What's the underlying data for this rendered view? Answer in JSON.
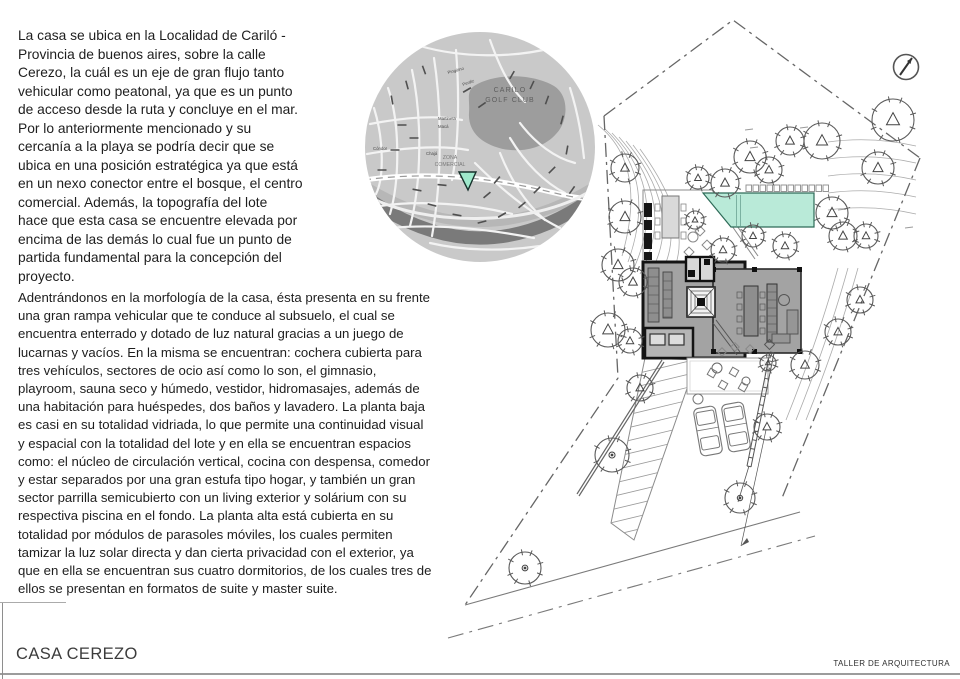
{
  "page": {
    "background_color": "#ffffff"
  },
  "intro": {
    "paragraph1": "La casa se ubica en la Localidad de Cariló -\nProvincia de buenos aires, sobre la calle\nCerezo, la cuál es un eje de gran flujo tanto\nvehicular como peatonal, ya que es un punto\nde acceso desde la ruta y concluye en el mar.\nPor lo anteriormente mencionado y su\ncercanía a la playa se podría decir que se\nubica en una posición estratégica ya que está\nen un nexo conector entre el bosque, el centro\ncomercial.   Además, la topografía del lote\nhace que esta casa se encuentre elevada por\nencima de las demás lo cual fue un punto de\npartida  fundamental para la concepción del\nproyecto.",
    "paragraph2": "Adentrándonos en la morfología de la casa, ésta presenta en su frente\nuna gran rampa vehicular que te conduce al subsuelo, el cual se\nencuentra enterrado y dotado de luz natural gracias a un juego de\nlucarnas y vacíos. En la misma se encuentran: cochera cubierta para\ntres  vehículos, sectores de ocio así como lo son, el gimnasio,\nplayroom, sauna seco y húmedo, vestidor, hidromasajes, además de\nuna habitación para huéspedes, dos baños y lavadero.  La planta baja\nes casi en su totalidad vidriada, lo que permite una  continuidad visual\ny espacial con la totalidad del lote y en ella se  encuentran espacios\ncomo: el núcleo de circulación vertical, cocina con despensa, comedor\ny estar separados por una gran estufa tipo hogar, y también un gran\nsector parrilla semicubierto con un living exterior y  solárium con su\nrespectiva piscina en el fondo.  La planta alta está cubierta en su\ntotalidad por módulos de parasoles móviles, los cuales permiten\ntamizar la luz solar directa y dan cierta  privacidad con el exterior, ya\nque en ella se encuentran sus cuatro dormitorios, de los cuales tres de\nellos se presentan en formatos de suite y master suite."
  },
  "location_map": {
    "golf_club_label": "CARILO\nGOLF CLUB",
    "commercial_zone_label": "ZONA\nCOMERCIAL",
    "street_names": [
      "Pingüino",
      "Perdiz",
      "Martineta",
      "Macá",
      "Chajá",
      "Cóndor"
    ],
    "marker_color": "#9fe9cc"
  },
  "site_plan": {
    "pool_color": "#b9ead8",
    "house_fill": "#a3a3a3"
  },
  "footer": {
    "project_title": "CASA CEREZO",
    "studio_name": "TALLER DE ARQUITECTURA"
  }
}
